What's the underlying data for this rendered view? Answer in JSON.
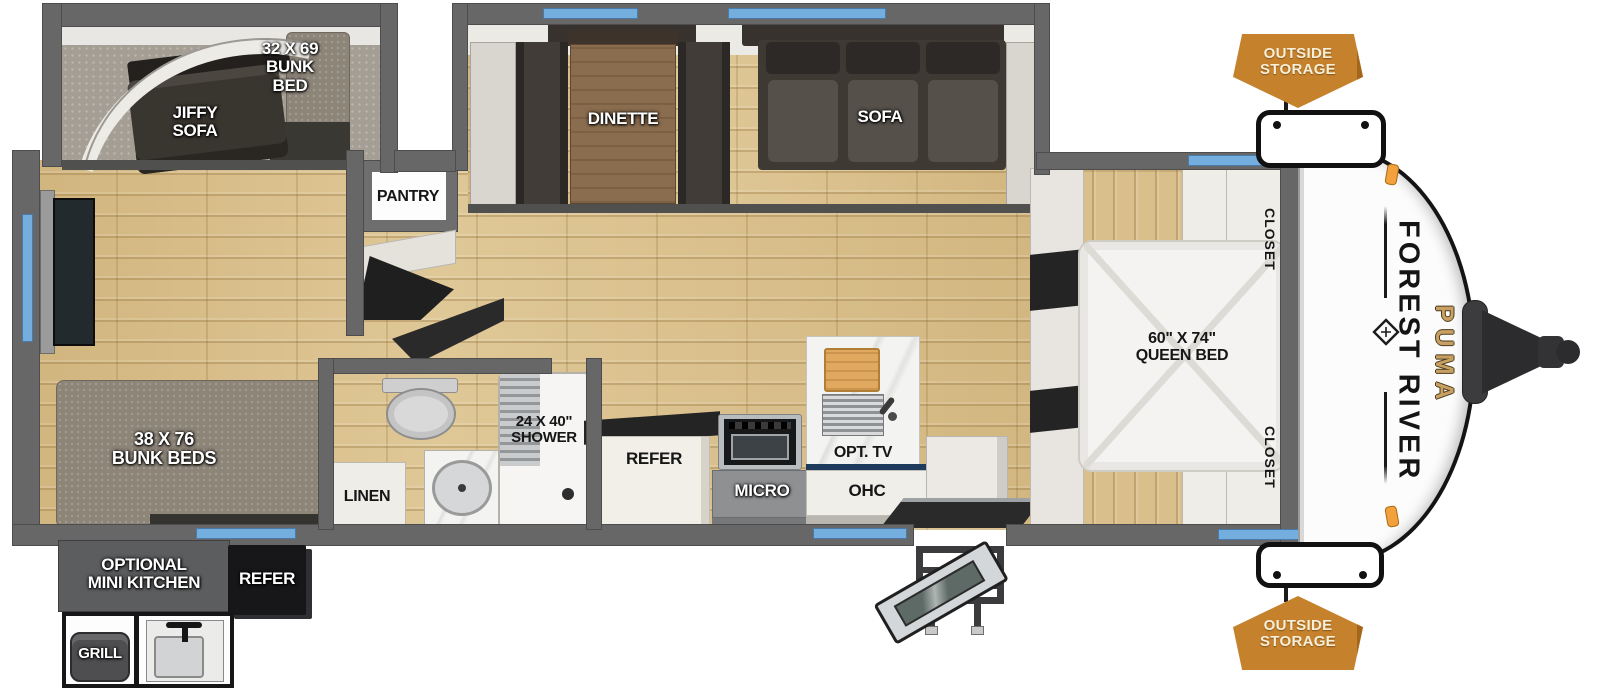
{
  "floorplan": {
    "title": "Forest River Puma travel trailer floor plan",
    "brand": {
      "manufacturer": "FOREST RIVER",
      "model": "PUMA"
    },
    "labels": {
      "bunk_bed": "32 X 69\nBUNK\nBED",
      "jiffy_sofa": "JIFFY\nSOFA",
      "bunk_beds": "38 X 76\nBUNK BEDS",
      "optional_mini_kitchen": "OPTIONAL\nMINI KITCHEN",
      "mini_kitchen_refer": "REFER",
      "grill": "GRILL",
      "pantry": "PANTRY",
      "dinette": "DINETTE",
      "sofa": "SOFA",
      "linen": "LINEN",
      "shower": "24 X 40\"\nSHOWER",
      "refer": "REFER",
      "micro": "MICRO",
      "ohc": "OHC",
      "opt_tv": "OPT. TV",
      "queen_bed": "60\" X 74\"\nQUEEN BED",
      "closet_top": "CLOSET",
      "closet_bottom": "CLOSET",
      "outside_storage_top": "OUTSIDE\nSTORAGE",
      "outside_storage_bottom": "OUTSIDE\nSTORAGE"
    },
    "colors": {
      "window_blue": "#74aede",
      "storage_orange": "#c5812c",
      "puma_gold": "#c9a063",
      "wall_gray": "#676767",
      "floor_wood": "#d8bf8c",
      "cap_white": "#fcfcfc"
    }
  }
}
